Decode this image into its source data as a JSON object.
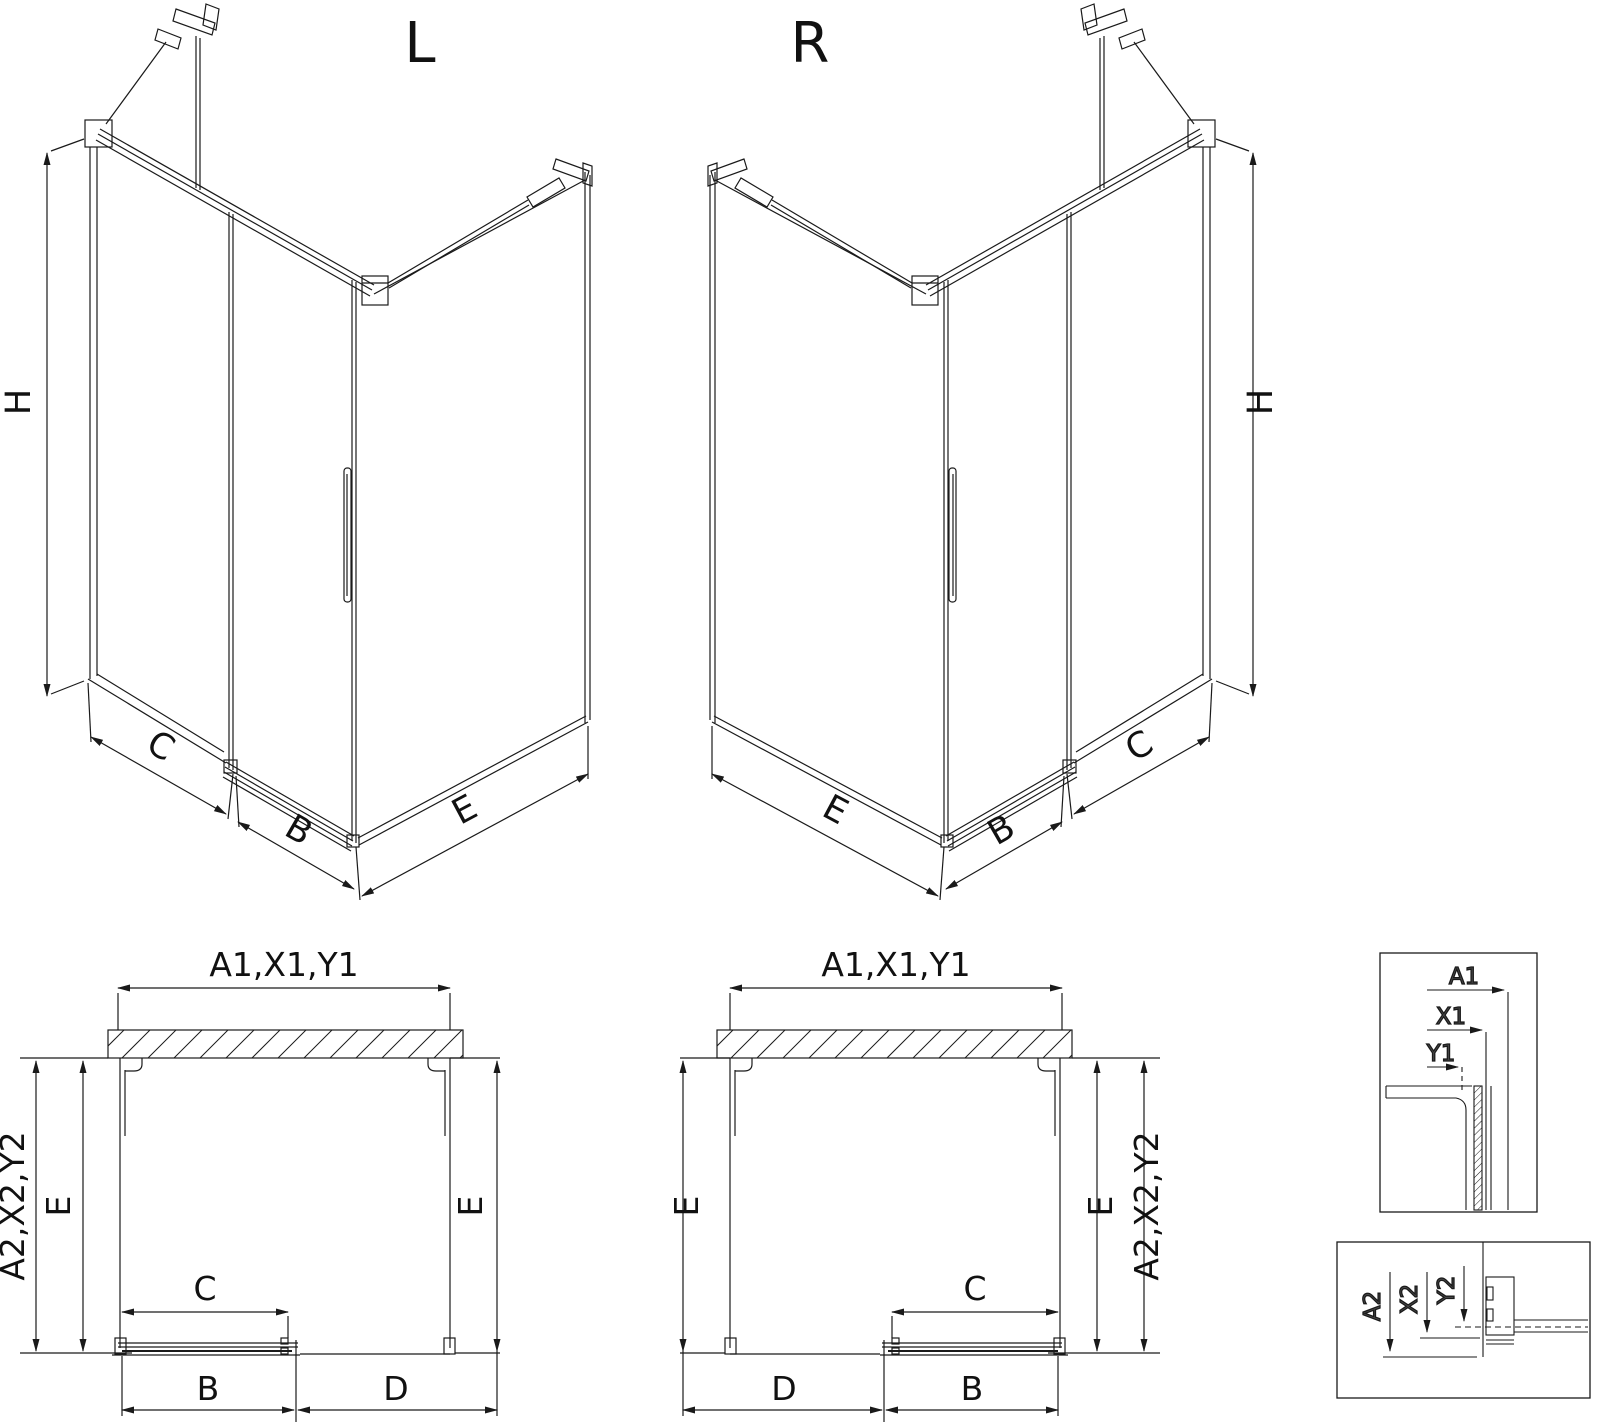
{
  "drawing": {
    "iso_l": {
      "title": "L",
      "h": "H",
      "c": "C",
      "b": "B",
      "e": "E"
    },
    "iso_r": {
      "title": "R",
      "h": "H",
      "c": "C",
      "b": "B",
      "e": "E"
    },
    "plan_l": {
      "width_top": "A1,X1,Y1",
      "depth_side": "A2,X2,Y2",
      "e_left": "E",
      "e_right": "E",
      "c": "C",
      "b": "B",
      "d": "D"
    },
    "plan_r": {
      "width_top": "A1,X1,Y1",
      "depth_side": "A2,X2,Y2",
      "e_left": "E",
      "e_right": "E",
      "c": "C",
      "b": "B",
      "d": "D"
    },
    "detail_top": {
      "a1": "A1",
      "x1": "X1",
      "y1": "Y1"
    },
    "detail_bottom": {
      "a2": "A2",
      "x2": "X2",
      "y2": "Y2"
    },
    "colors": {
      "line": "#1a1a1a",
      "detail_label": "#4a4a4a",
      "background": "#ffffff"
    }
  }
}
